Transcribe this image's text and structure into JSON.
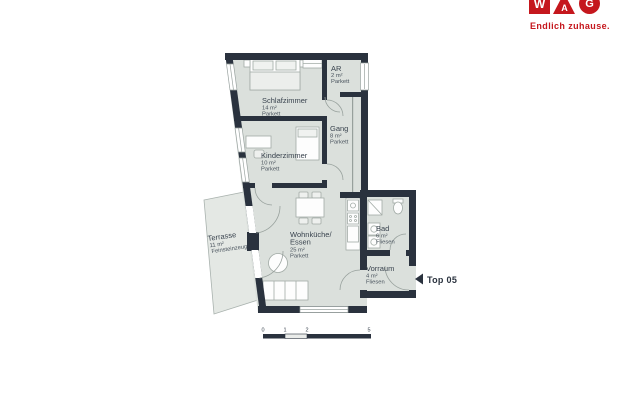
{
  "brand": {
    "letters": [
      "W",
      "A",
      "G"
    ],
    "tagline": "Endlich zuhause.",
    "color": "#c5171d"
  },
  "plan": {
    "unit": "Top 05",
    "rooms": {
      "schlafzimmer": {
        "name": "Schlafzimmer",
        "area": "14 m²",
        "floor": "Parkett"
      },
      "ar": {
        "name": "AR",
        "area": "2 m²",
        "floor": "Parkett"
      },
      "gang": {
        "name": "Gang",
        "area": "8 m²",
        "floor": "Parkett"
      },
      "kinderzimmer": {
        "name": "Kinderzimmer",
        "area": "10 m²",
        "floor": "Parkett"
      },
      "terrasse": {
        "name": "Terrasse",
        "area": "11 m²",
        "floor": "Feinsteinzeug"
      },
      "wohnkueche": {
        "name1": "Wohnküche/",
        "name2": "Essen",
        "area": "25 m²",
        "floor": "Parkett"
      },
      "bad": {
        "name": "Bad",
        "area": "6 m²",
        "floor": "Fliesen"
      },
      "vorraum": {
        "name": "Vorraum",
        "area": "4 m²",
        "floor": "Fliesen"
      }
    },
    "scale": {
      "t0": "0",
      "t1": "1",
      "t2": "2",
      "t3": "5"
    },
    "colors": {
      "wall": "#2a323e",
      "room_fill": "#dbe0dc",
      "terrace_fill": "#e4e8e4"
    }
  }
}
